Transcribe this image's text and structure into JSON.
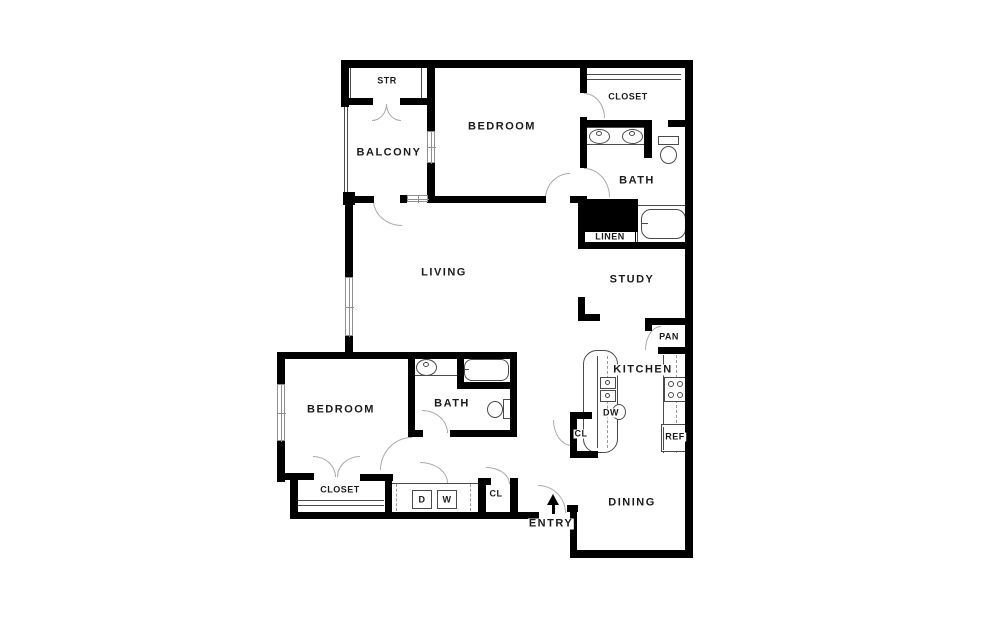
{
  "title": "Two bedroom apartment floor plan",
  "canvas": {
    "w": 998,
    "h": 626,
    "bg": "#ffffff"
  },
  "style": {
    "wall": "#000000",
    "door_arc": "#a9a9a9",
    "fixture": "#4a4a4a",
    "window": "#8f8f8f",
    "label": "#1b1b1b",
    "big_label_px": 11,
    "small_label_px": 9
  },
  "labels": [
    {
      "t": "STR",
      "x": 387,
      "y": 81,
      "s": "small"
    },
    {
      "t": "BALCONY",
      "x": 389,
      "y": 153,
      "s": "big"
    },
    {
      "t": "BEDROOM",
      "x": 502,
      "y": 127,
      "s": "big"
    },
    {
      "t": "CLOSET",
      "x": 628,
      "y": 97,
      "s": "small"
    },
    {
      "t": "BATH",
      "x": 637,
      "y": 181,
      "s": "big"
    },
    {
      "t": "LINEN",
      "x": 610,
      "y": 237,
      "s": "small"
    },
    {
      "t": "LIVING",
      "x": 444,
      "y": 273,
      "s": "big"
    },
    {
      "t": "STUDY",
      "x": 632,
      "y": 280,
      "s": "big"
    },
    {
      "t": "PAN",
      "x": 669,
      "y": 337,
      "s": "small"
    },
    {
      "t": "KITCHEN",
      "x": 643,
      "y": 370,
      "s": "big"
    },
    {
      "t": "DW",
      "x": 611,
      "y": 413,
      "s": "small"
    },
    {
      "t": "CL",
      "x": 581,
      "y": 434,
      "s": "small"
    },
    {
      "t": "REF",
      "x": 675,
      "y": 437,
      "s": "small"
    },
    {
      "t": "BEDROOM",
      "x": 341,
      "y": 410,
      "s": "big"
    },
    {
      "t": "BATH",
      "x": 452,
      "y": 404,
      "s": "big"
    },
    {
      "t": "CLOSET",
      "x": 340,
      "y": 490,
      "s": "small"
    },
    {
      "t": "D",
      "x": 422,
      "y": 500,
      "s": "small"
    },
    {
      "t": "W",
      "x": 447,
      "y": 500,
      "s": "small"
    },
    {
      "t": "CL",
      "x": 496,
      "y": 494,
      "s": "small"
    },
    {
      "t": "ENTRY",
      "x": 551,
      "y": 524,
      "s": "big"
    },
    {
      "t": "DINING",
      "x": 632,
      "y": 503,
      "s": "big"
    }
  ],
  "walls": [
    [
      341,
      60,
      352,
      8
    ],
    [
      685,
      60,
      8,
      498
    ],
    [
      341,
      60,
      8,
      47
    ],
    [
      341,
      98,
      32,
      7
    ],
    [
      400,
      98,
      31,
      7
    ],
    [
      427,
      60,
      8,
      72
    ],
    [
      427,
      162,
      8,
      41
    ],
    [
      343,
      192,
      12,
      13
    ],
    [
      353,
      196,
      21,
      7
    ],
    [
      400,
      195,
      7,
      8
    ],
    [
      345,
      200,
      8,
      78
    ],
    [
      345,
      335,
      8,
      24
    ],
    [
      427,
      196,
      119,
      7
    ],
    [
      570,
      196,
      17,
      7
    ],
    [
      580,
      60,
      7,
      33
    ],
    [
      580,
      117,
      7,
      51
    ],
    [
      581,
      120,
      71,
      7
    ],
    [
      644,
      120,
      8,
      38
    ],
    [
      668,
      120,
      25,
      7
    ],
    [
      578,
      196,
      7,
      53
    ],
    [
      578,
      242,
      115,
      7
    ],
    [
      578,
      297,
      7,
      24
    ],
    [
      578,
      314,
      22,
      7
    ],
    [
      645,
      318,
      48,
      7
    ],
    [
      658,
      347,
      35,
      7
    ],
    [
      645,
      318,
      7,
      13
    ],
    [
      570,
      412,
      22,
      7
    ],
    [
      570,
      412,
      7,
      46
    ],
    [
      570,
      451,
      28,
      7
    ],
    [
      277,
      352,
      240,
      7
    ],
    [
      277,
      352,
      8,
      34
    ],
    [
      277,
      440,
      8,
      42
    ],
    [
      277,
      473,
      37,
      7
    ],
    [
      360,
      474,
      33,
      7
    ],
    [
      290,
      480,
      8,
      39
    ],
    [
      290,
      512,
      249,
      7
    ],
    [
      385,
      478,
      7,
      36
    ],
    [
      478,
      478,
      8,
      36
    ],
    [
      478,
      478,
      13,
      7
    ],
    [
      510,
      478,
      8,
      41
    ],
    [
      567,
      505,
      11,
      7
    ],
    [
      570,
      505,
      7,
      53
    ],
    [
      570,
      550,
      123,
      8
    ],
    [
      408,
      352,
      7,
      85
    ],
    [
      408,
      430,
      15,
      7
    ],
    [
      450,
      430,
      67,
      7
    ],
    [
      510,
      352,
      7,
      85
    ],
    [
      457,
      352,
      7,
      33
    ],
    [
      457,
      382,
      60,
      7
    ]
  ],
  "windows": [
    {
      "x": 427,
      "y": 131,
      "w": 8,
      "h": 32
    },
    {
      "x": 345,
      "y": 277,
      "w": 8,
      "h": 59
    },
    {
      "x": 277,
      "y": 384,
      "w": 8,
      "h": 57
    },
    {
      "x": 407,
      "y": 195,
      "w": 21,
      "h": 7
    }
  ],
  "doors": [
    {
      "n": "str-door-left",
      "x": 372,
      "y": 104,
      "w": 15,
      "h": 17,
      "q": "br"
    },
    {
      "n": "str-door-right",
      "x": 386,
      "y": 104,
      "w": 15,
      "h": 17,
      "q": "bl"
    },
    {
      "n": "balcony-door",
      "x": 373,
      "y": 200,
      "w": 29,
      "h": 26,
      "q": "bl"
    },
    {
      "n": "bedroom1-door",
      "x": 545,
      "y": 173,
      "w": 25,
      "h": 26,
      "q": "tl"
    },
    {
      "n": "closet1-door",
      "x": 584,
      "y": 93,
      "w": 21,
      "h": 25,
      "q": "tr"
    },
    {
      "n": "bath1-door",
      "x": 584,
      "y": 168,
      "w": 26,
      "h": 29,
      "q": "tr"
    },
    {
      "n": "entry-door",
      "x": 538,
      "y": 485,
      "w": 28,
      "h": 28,
      "q": "tr"
    },
    {
      "n": "pantry-door",
      "x": 645,
      "y": 326,
      "w": 16,
      "h": 24,
      "q": "tl"
    },
    {
      "n": "kitchen-cl-door",
      "x": 553,
      "y": 420,
      "w": 19,
      "h": 26,
      "q": "bl"
    },
    {
      "n": "bath2-door",
      "x": 422,
      "y": 410,
      "w": 26,
      "h": 23,
      "q": "tr"
    },
    {
      "n": "bedroom2-door",
      "x": 380,
      "y": 437,
      "w": 32,
      "h": 33,
      "q": "tl"
    },
    {
      "n": "closet2-door-left",
      "x": 313,
      "y": 456,
      "w": 23,
      "h": 21,
      "q": "tr"
    },
    {
      "n": "closet2-door-right",
      "x": 337,
      "y": 456,
      "w": 23,
      "h": 21,
      "q": "tl"
    },
    {
      "n": "laundry-door",
      "x": 420,
      "y": 462,
      "w": 28,
      "h": 21,
      "q": "tr"
    },
    {
      "n": "cl2-door",
      "x": 486,
      "y": 467,
      "w": 24,
      "h": 17,
      "q": "tr"
    }
  ],
  "fixtures": [
    {
      "n": "balcony-railing",
      "t": "l",
      "x": 344,
      "y": 106,
      "w": 1,
      "h": 88
    },
    {
      "n": "balcony-railing",
      "t": "l",
      "x": 347,
      "y": 106,
      "w": 1,
      "h": 88
    },
    {
      "n": "str-jamb",
      "t": "l",
      "x": 350,
      "y": 68,
      "w": 1,
      "h": 31
    },
    {
      "n": "str-jamb",
      "t": "l",
      "x": 421,
      "y": 68,
      "w": 1,
      "h": 31
    },
    {
      "n": "closet1-rod",
      "t": "l",
      "x": 587,
      "y": 74,
      "w": 94,
      "h": 1
    },
    {
      "n": "closet1-rod",
      "t": "l",
      "x": 587,
      "y": 79,
      "w": 94,
      "h": 1
    },
    {
      "n": "vanity1-counter",
      "t": "r",
      "x": 582,
      "y": 127,
      "w": 70,
      "h": 18
    },
    {
      "n": "vanity1-sink",
      "t": "o",
      "x": 589,
      "y": 129,
      "w": 21,
      "h": 15
    },
    {
      "n": "vanity1-faucet",
      "t": "o",
      "x": 596,
      "y": 131,
      "w": 6,
      "h": 5
    },
    {
      "n": "vanity1-sink",
      "t": "o",
      "x": 622,
      "y": 129,
      "w": 21,
      "h": 15
    },
    {
      "n": "vanity1-faucet",
      "t": "o",
      "x": 629,
      "y": 131,
      "w": 6,
      "h": 5
    },
    {
      "n": "toilet1-tank",
      "t": "r",
      "x": 658,
      "y": 136,
      "w": 21,
      "h": 9
    },
    {
      "n": "toilet1-bowl",
      "t": "o",
      "x": 660,
      "y": 146,
      "w": 17,
      "h": 18
    },
    {
      "n": "bathtub1",
      "t": "r",
      "x": 637,
      "y": 205,
      "w": 53,
      "h": 38
    },
    {
      "n": "bathtub1-basin",
      "t": "rr",
      "x": 641,
      "y": 209,
      "w": 45,
      "h": 30,
      "r": 10
    },
    {
      "n": "bathtub1-faucet",
      "t": "l",
      "x": 641,
      "y": 223,
      "w": 7,
      "h": 1
    },
    {
      "n": "linen-block",
      "t": "f",
      "x": 581,
      "y": 199,
      "w": 57,
      "h": 33
    },
    {
      "n": "linen-label-box",
      "t": "w",
      "x": 584,
      "y": 231,
      "w": 52,
      "h": 13
    },
    {
      "n": "kitchen-island",
      "t": "rr",
      "x": 583,
      "y": 350,
      "w": 35,
      "h": 103,
      "r": 14
    },
    {
      "n": "island-cabinet-line",
      "t": "l",
      "x": 597,
      "y": 356,
      "w": 1,
      "h": 92
    },
    {
      "n": "island-centerline",
      "t": "d",
      "x": 607,
      "y": 356,
      "w": 1,
      "h": 92
    },
    {
      "n": "island-sink-basin",
      "t": "r",
      "x": 600,
      "y": 377,
      "w": 16,
      "h": 12
    },
    {
      "n": "island-sink-basin",
      "t": "r",
      "x": 600,
      "y": 390,
      "w": 16,
      "h": 12
    },
    {
      "n": "island-sink-drain",
      "t": "o",
      "x": 605,
      "y": 380,
      "w": 5,
      "h": 5
    },
    {
      "n": "island-sink-drain",
      "t": "o",
      "x": 605,
      "y": 393,
      "w": 5,
      "h": 5
    },
    {
      "n": "island-bump",
      "t": "o",
      "x": 612,
      "y": 404,
      "w": 14,
      "h": 16
    },
    {
      "n": "counter-edge",
      "t": "l",
      "x": 663,
      "y": 355,
      "w": 1,
      "h": 98
    },
    {
      "n": "counter-centerline",
      "t": "d",
      "x": 676,
      "y": 355,
      "w": 1,
      "h": 98
    },
    {
      "n": "stove",
      "t": "r",
      "x": 664,
      "y": 377,
      "w": 22,
      "h": 25
    },
    {
      "n": "burner",
      "t": "o",
      "x": 668,
      "y": 381,
      "w": 6,
      "h": 6
    },
    {
      "n": "burner",
      "t": "o",
      "x": 677,
      "y": 381,
      "w": 6,
      "h": 6
    },
    {
      "n": "burner",
      "t": "o",
      "x": 668,
      "y": 392,
      "w": 6,
      "h": 6
    },
    {
      "n": "burner",
      "t": "o",
      "x": 677,
      "y": 392,
      "w": 6,
      "h": 6
    },
    {
      "n": "refrigerator",
      "t": "r",
      "x": 661,
      "y": 424,
      "w": 25,
      "h": 28
    },
    {
      "n": "refrigerator-line",
      "t": "l",
      "x": 663,
      "y": 427,
      "w": 1,
      "h": 23
    },
    {
      "n": "laundry-front",
      "t": "l",
      "x": 392,
      "y": 483,
      "w": 87,
      "h": 1
    },
    {
      "n": "laundry-dash",
      "t": "d",
      "x": 396,
      "y": 484,
      "w": 1,
      "h": 27
    },
    {
      "n": "laundry-dash",
      "t": "d",
      "x": 470,
      "y": 484,
      "w": 1,
      "h": 27
    },
    {
      "n": "dryer-box",
      "t": "r",
      "x": 412,
      "y": 490,
      "w": 20,
      "h": 19
    },
    {
      "n": "washer-box",
      "t": "r",
      "x": 437,
      "y": 490,
      "w": 20,
      "h": 19
    },
    {
      "n": "closet2-shelf",
      "t": "l",
      "x": 297,
      "y": 500,
      "w": 87,
      "h": 1
    },
    {
      "n": "closet2-shelf",
      "t": "l",
      "x": 297,
      "y": 505,
      "w": 87,
      "h": 1
    },
    {
      "n": "bath2-sink",
      "t": "o",
      "x": 416,
      "y": 359,
      "w": 21,
      "h": 17
    },
    {
      "n": "bath2-faucet",
      "t": "o",
      "x": 423,
      "y": 362,
      "w": 6,
      "h": 5
    },
    {
      "n": "bath2-counter",
      "t": "l",
      "x": 410,
      "y": 375,
      "w": 48,
      "h": 1
    },
    {
      "n": "bathtub2-basin",
      "t": "rr",
      "x": 464,
      "y": 359,
      "w": 45,
      "h": 22,
      "r": 8
    },
    {
      "n": "bathtub2-faucet",
      "t": "l",
      "x": 460,
      "y": 369,
      "w": 9,
      "h": 1
    },
    {
      "n": "toilet2-tank",
      "t": "r",
      "x": 503,
      "y": 399,
      "w": 8,
      "h": 20
    },
    {
      "n": "toilet2-bowl",
      "t": "o",
      "x": 487,
      "y": 401,
      "w": 16,
      "h": 17
    },
    {
      "n": "entry-arrow-head",
      "t": "tri",
      "x": 547,
      "y": 494,
      "w": 13,
      "h": 11
    },
    {
      "n": "entry-arrow-stem",
      "t": "f",
      "x": 552,
      "y": 505,
      "w": 3,
      "h": 9
    }
  ]
}
